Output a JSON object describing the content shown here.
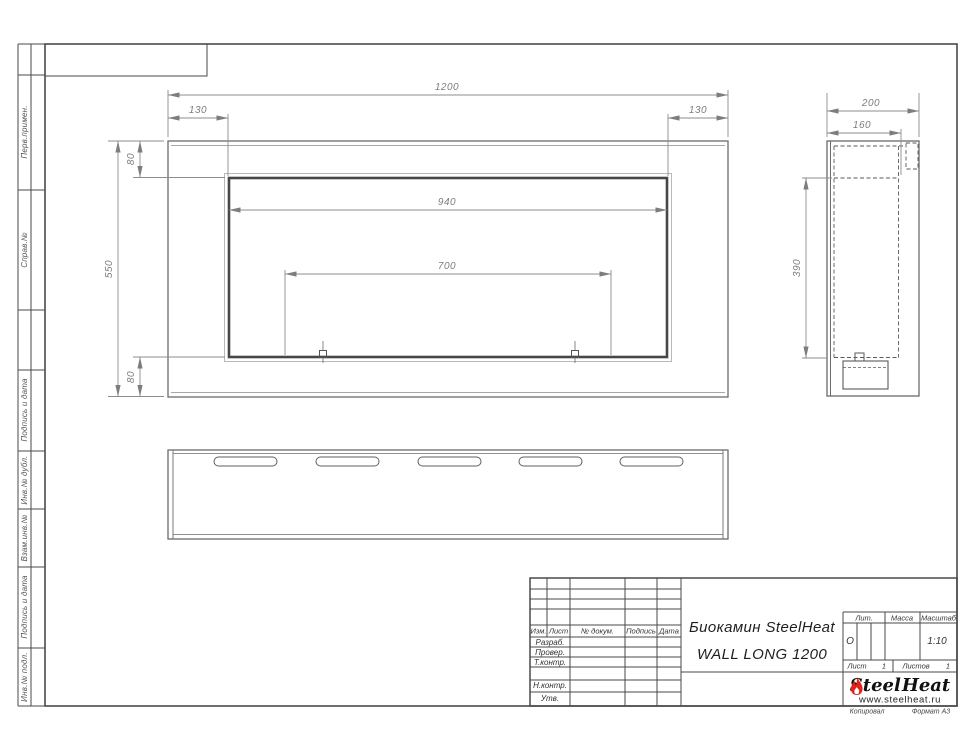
{
  "sheet": {
    "margin_labels": {
      "perv_primen": "Перв.примен.",
      "sprav_no": "Справ.№",
      "podpis_i_data_1": "Подпись и дата",
      "inv_no_dubl": "Инв.№ дубл.",
      "vzam_inv_no": "Взам.инв.№",
      "podpis_i_data_2": "Подпись и дата",
      "inv_no_podl": "Инв.№ подл."
    },
    "footer": {
      "kopiroval": "Копировал",
      "format": "Формат А3"
    }
  },
  "dimensions": {
    "front_view": {
      "width": "1200",
      "left_offset": "130",
      "right_offset": "130",
      "top_offset": "80",
      "height": "550",
      "bottom_offset": "80",
      "opening_width": "940",
      "burner_width": "700"
    },
    "side_view": {
      "depth": "200",
      "inner_depth": "160",
      "opening_height": "390"
    }
  },
  "title_block": {
    "header_cols": {
      "izm": "Изм.",
      "list": "Лист",
      "doc_no": "№ докум.",
      "podpis": "Подпись",
      "data": "Дата"
    },
    "rows": {
      "razrab": "Разраб.",
      "prover": "Провер.",
      "tkontr": "Т.контр.",
      "nkontr": "Н.контр.",
      "utv": "Утв."
    },
    "name_line1": "Биокамин SteelHeat",
    "name_line2": "WALL LONG 1200",
    "lit_label": "Лит.",
    "massa_label": "Масса",
    "masshtab_label": "Масштаб",
    "lit_value": "О",
    "scale_value": "1:10",
    "list_label": "Лист",
    "list_value": "1",
    "listov_label": "Листов",
    "listov_value": "1",
    "logo": {
      "part1": "Steel",
      "part2": "Heat",
      "url": "www.steelheat.ru",
      "flame_color": "#e2231a"
    }
  }
}
